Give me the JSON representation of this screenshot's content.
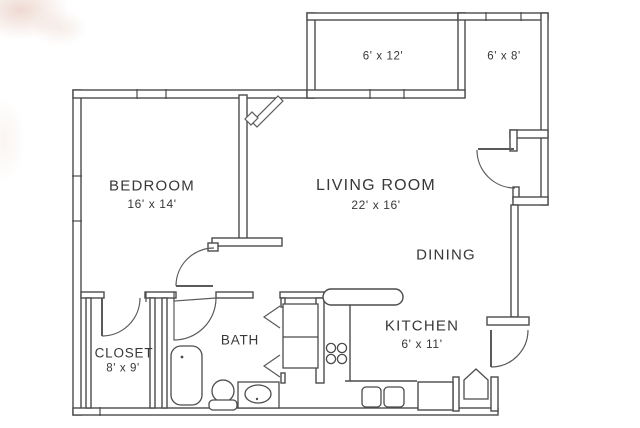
{
  "plan": {
    "balcony": {
      "dims": "6' x 12'"
    },
    "patio": {
      "dims": "6' x 8'"
    },
    "bedroom": {
      "name": "BEDROOM",
      "dims": "16' x 14'"
    },
    "living_room": {
      "name": "LIVING ROOM",
      "dims": "22' x 16'"
    },
    "dining": {
      "name": "DINING"
    },
    "kitchen": {
      "name": "KITCHEN",
      "dims": "6' x 11'"
    },
    "bath": {
      "name": "BATH"
    },
    "closet": {
      "name": "CLOSET",
      "dims": "8' x 9'"
    }
  },
  "colors": {
    "wall_line": "#4b4b4b",
    "text": "#383838",
    "background": "#ffffff"
  }
}
